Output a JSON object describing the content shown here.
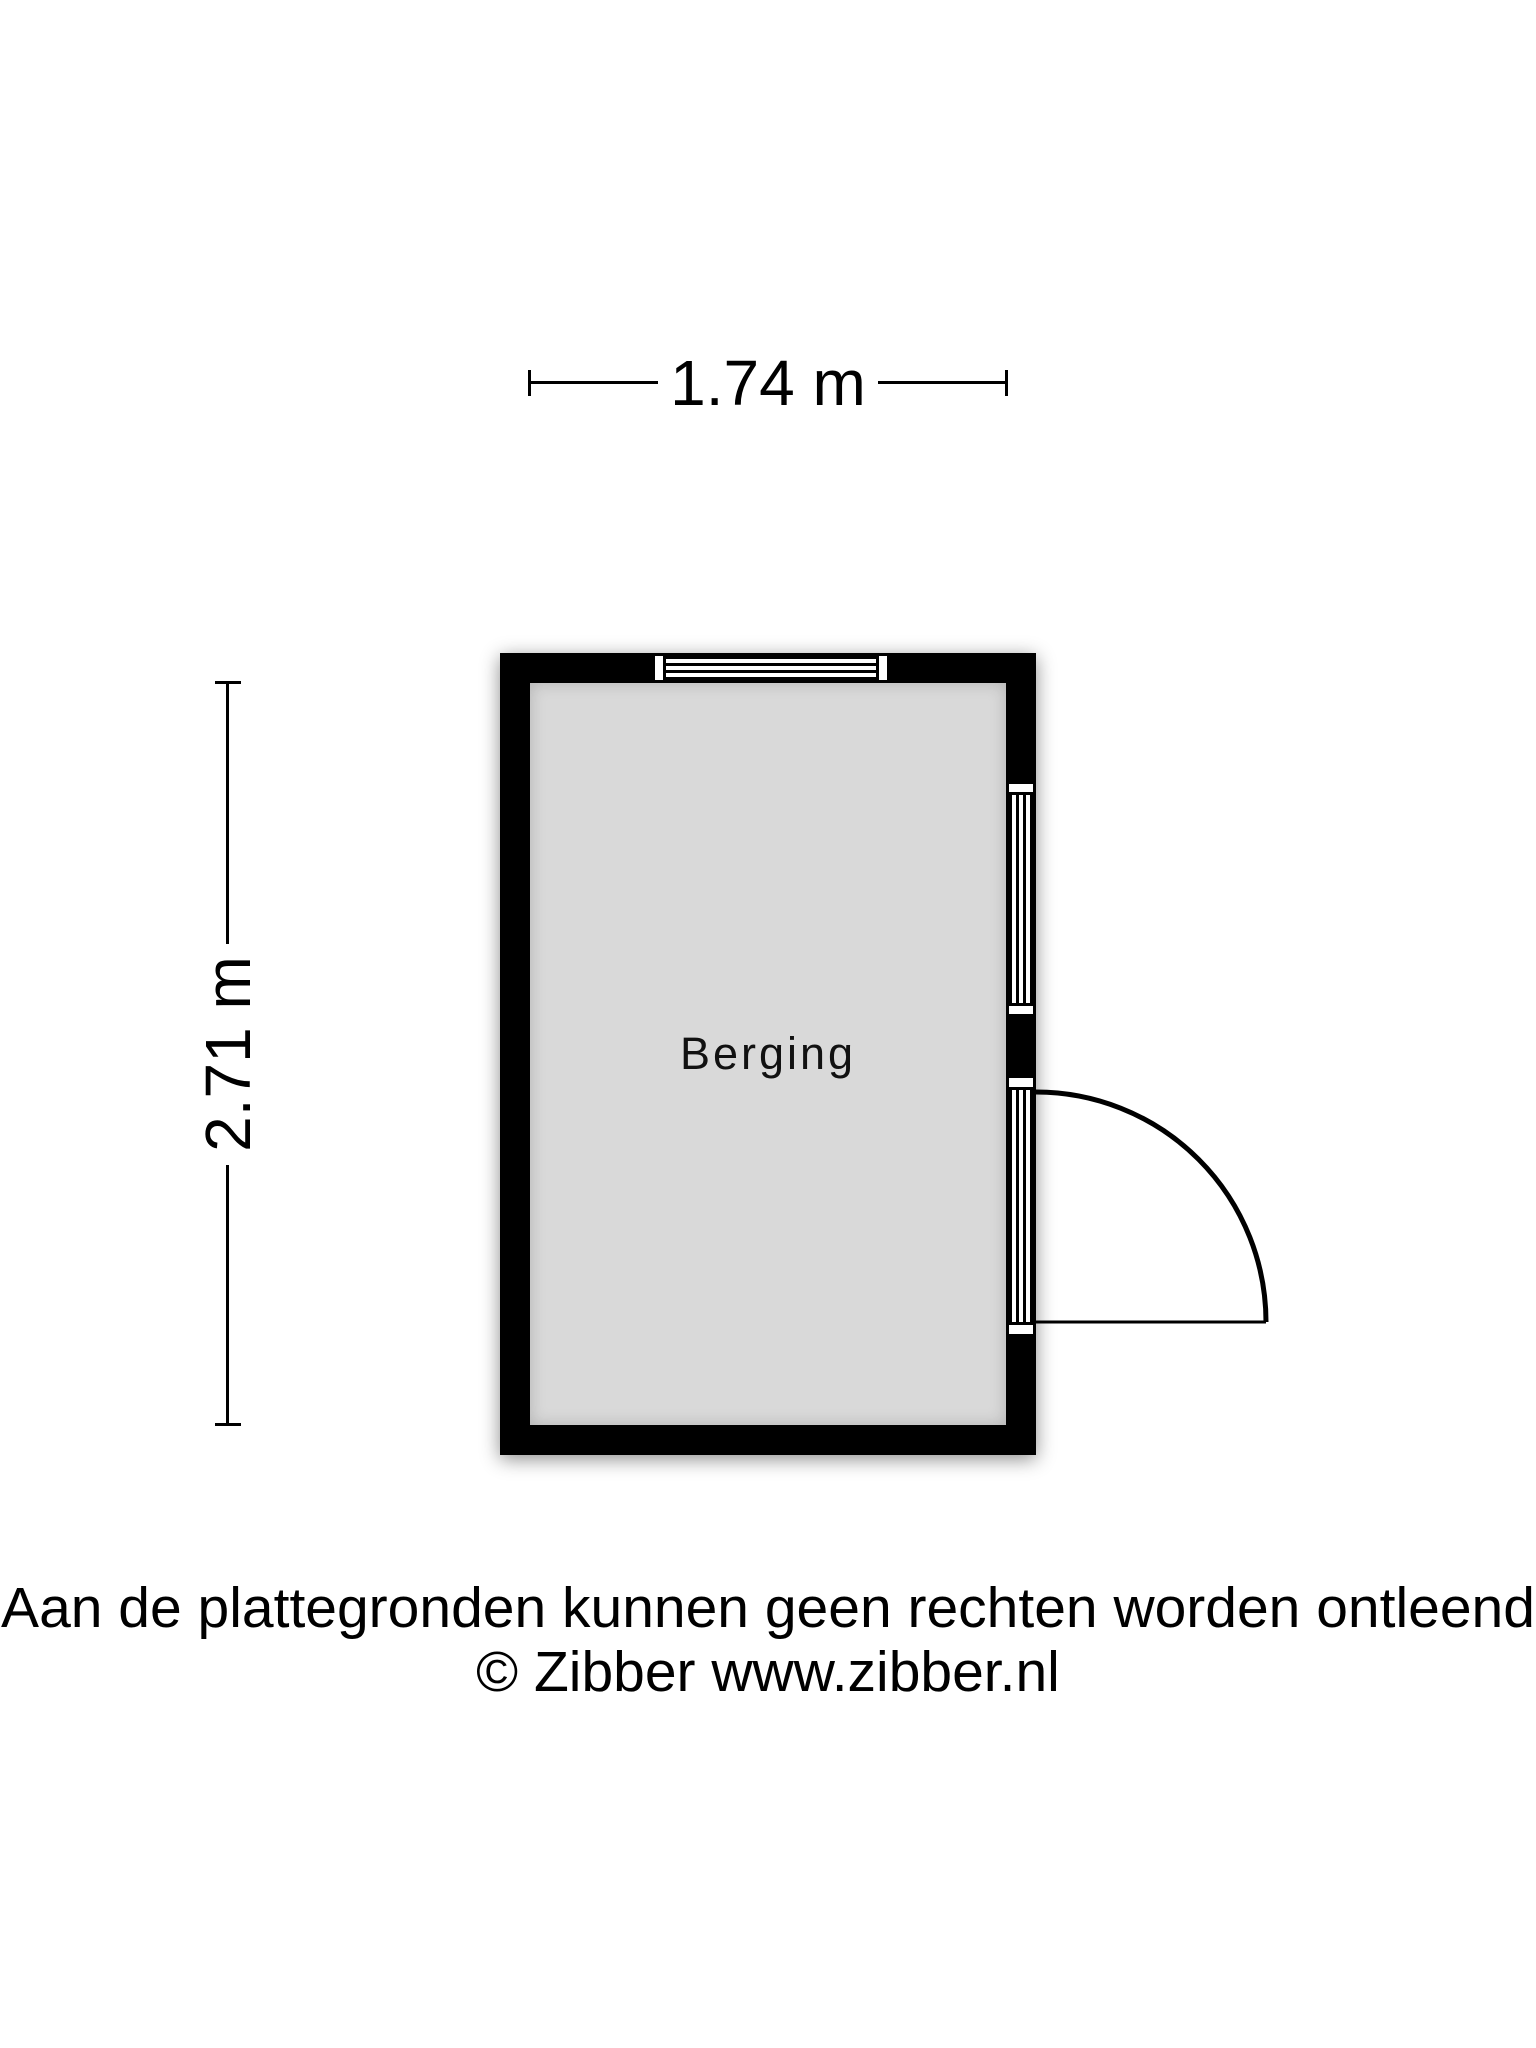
{
  "plan": {
    "room": {
      "label": "Berging"
    },
    "dimensions": {
      "width": "1.74 m",
      "depth": "2.71 m"
    },
    "symbols": [
      "top-window",
      "right-window",
      "right-door-with-swing"
    ]
  },
  "footer": {
    "disclaimer": "Aan de plattegronden kunnen geen rechten worden ontleend",
    "copyright": "© Zibber www.zibber.nl"
  },
  "colors": {
    "wall": "#000000",
    "room_fill": "#d9d9d9",
    "background": "#ffffff",
    "text": "#000000"
  }
}
